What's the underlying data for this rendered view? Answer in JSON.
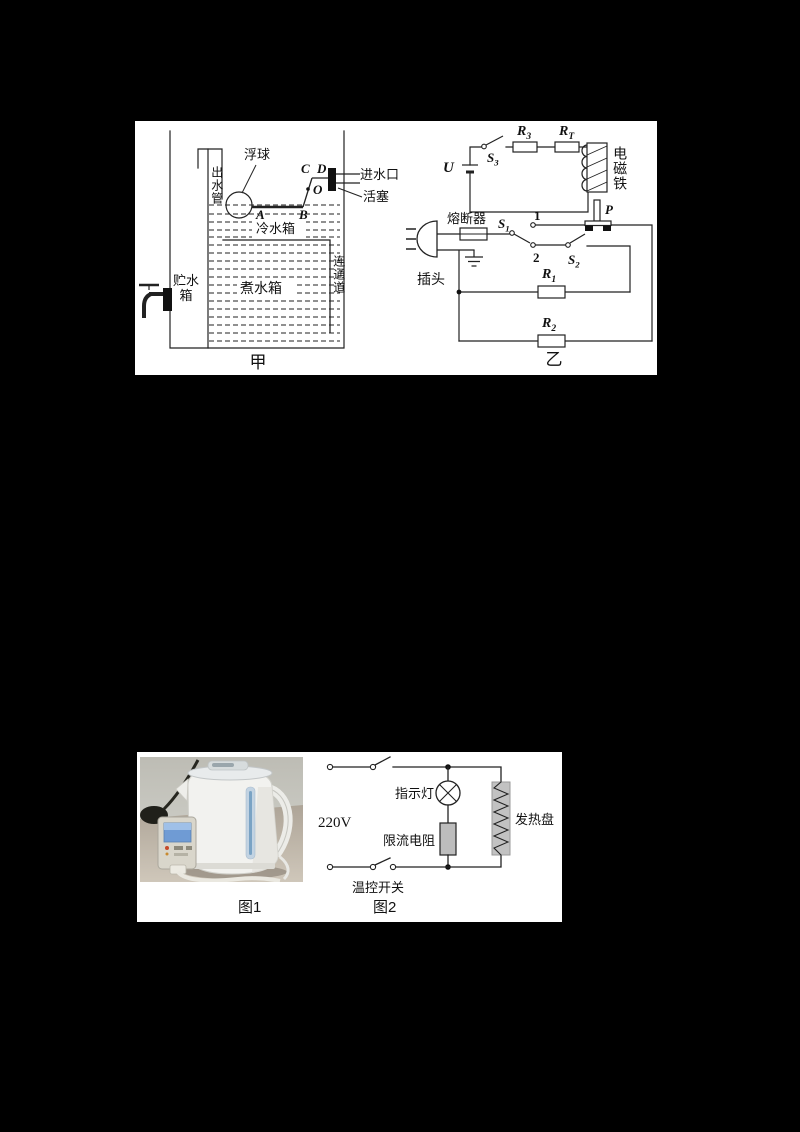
{
  "fig1": {
    "caption_left": "甲",
    "caption_right": "乙",
    "tank": {
      "float_ball": "浮球",
      "outlet_pipe": "出水管",
      "cold_tank": "冷水箱",
      "boil_tank": "煮水箱",
      "storage_line1": "贮水",
      "storage_line2": "箱",
      "channel": "连通道",
      "inlet": "进水口",
      "piston": "活塞",
      "pt_a": "A",
      "pt_b": "B",
      "pt_c": "C",
      "pt_d": "D",
      "pt_o": "O"
    },
    "circuit": {
      "u": "U",
      "s3": {
        "b": "S",
        "s": "3"
      },
      "r3": {
        "b": "R",
        "s": "3"
      },
      "rt": {
        "b": "R",
        "s": "T"
      },
      "magnet": "电磁铁",
      "p": "P",
      "fuse": "熔断器",
      "s1": {
        "b": "S",
        "s": "1"
      },
      "n1": "1",
      "n2": "2",
      "s2": {
        "b": "S",
        "s": "2"
      },
      "plug": "插头",
      "r1": {
        "b": "R",
        "s": "1"
      },
      "r2": {
        "b": "R",
        "s": "2"
      }
    }
  },
  "fig2": {
    "caption_photo": "图1",
    "caption_circuit": "图2",
    "circuit": {
      "voltage": "220V",
      "indicator": "指示灯",
      "limiter": "限流电阻",
      "thermoswitch": "温控开关",
      "heater": "发热盘"
    }
  },
  "colors": {
    "page_bg": "#000000",
    "panel_bg": "#ffffff",
    "line": "#222222",
    "component_gray": "#bdbdbd",
    "heater_gray": "#c2c2c2",
    "meter_screen_blue": "#6f9bd4",
    "kettle_window_blue": "#9fc0df"
  }
}
